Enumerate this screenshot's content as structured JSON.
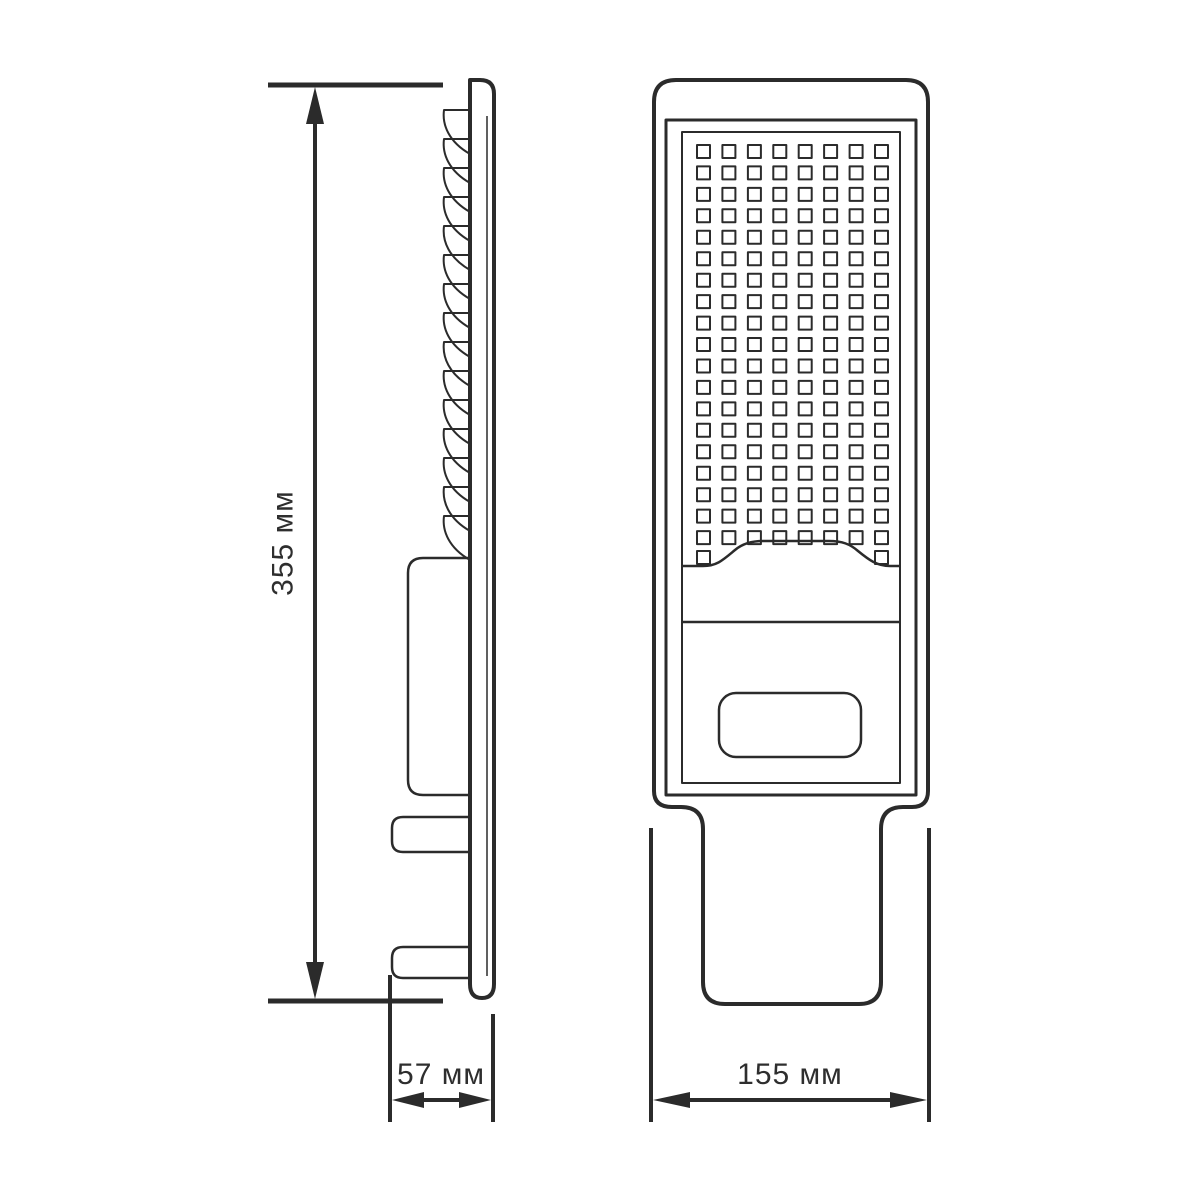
{
  "canvas": {
    "background": "#ffffff"
  },
  "palette": {
    "ink": "#2b2b2b",
    "text": "#2e2e2e"
  },
  "drawing": {
    "type": "technical-dimension-drawing",
    "subject": "LED street light fixture, two orthographic views",
    "side_view": {
      "heatsink_fin_count": 15,
      "parts": [
        "back-plate",
        "heatsink-fins",
        "driver-housing",
        "mounting-tab-top",
        "mounting-tab-bottom"
      ]
    },
    "front_view": {
      "led_grid": {
        "columns": 8,
        "full_rows": 19,
        "partial_row_columns": [
          0,
          7
        ],
        "total_leds": 154
      },
      "parts": [
        "lamp-body",
        "inner-frame",
        "led-panel",
        "led-window-wave",
        "body-divider",
        "driver-label-window",
        "mounting-arm"
      ]
    },
    "dimensions": {
      "height": {
        "label": "355 мм"
      },
      "depth": {
        "label": "57 мм"
      },
      "width": {
        "label": "155 мм"
      }
    }
  }
}
